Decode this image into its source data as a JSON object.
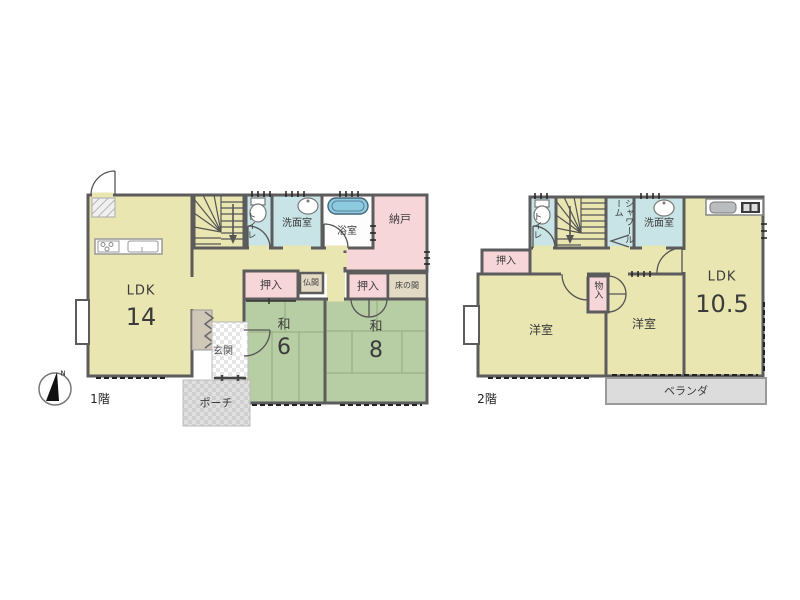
{
  "compass": {
    "north_label": "N"
  },
  "floor1": {
    "floor_label": "1階",
    "ldk": {
      "label": "LDK",
      "size": "14"
    },
    "toilet": "トイレ",
    "washroom": "洗面室",
    "bath": "浴室",
    "storeroom": "納戸",
    "closet_left": "押入",
    "butsuma": "仏間",
    "closet_right": "押入",
    "tokonoma": "床の間",
    "tatami6": {
      "label": "和",
      "size": "6"
    },
    "tatami8": {
      "label": "和",
      "size": "8"
    },
    "entrance": "玄関",
    "porch": "ポーチ"
  },
  "floor2": {
    "floor_label": "2階",
    "toilet": "トイレ",
    "shower_room": "シャワールーム",
    "washroom": "洗面室",
    "ldk": {
      "label": "LDK",
      "size": "10.5"
    },
    "closet": "押入",
    "storage": "物入",
    "western_room_left": "洋室",
    "western_room_right": "洋室",
    "veranda": "ベランダ"
  },
  "colors": {
    "wall": "#5c5c5c",
    "room_yellow": "#e9e6b2",
    "tatami_green": "#b7cda4",
    "closet_pink": "#f7d6da",
    "wet_cyan": "#c8e4e6",
    "alcove_tan": "#e3dac5",
    "bathtub_blue": "#8ccadf",
    "veranda_gray": "#dcdcdc"
  }
}
